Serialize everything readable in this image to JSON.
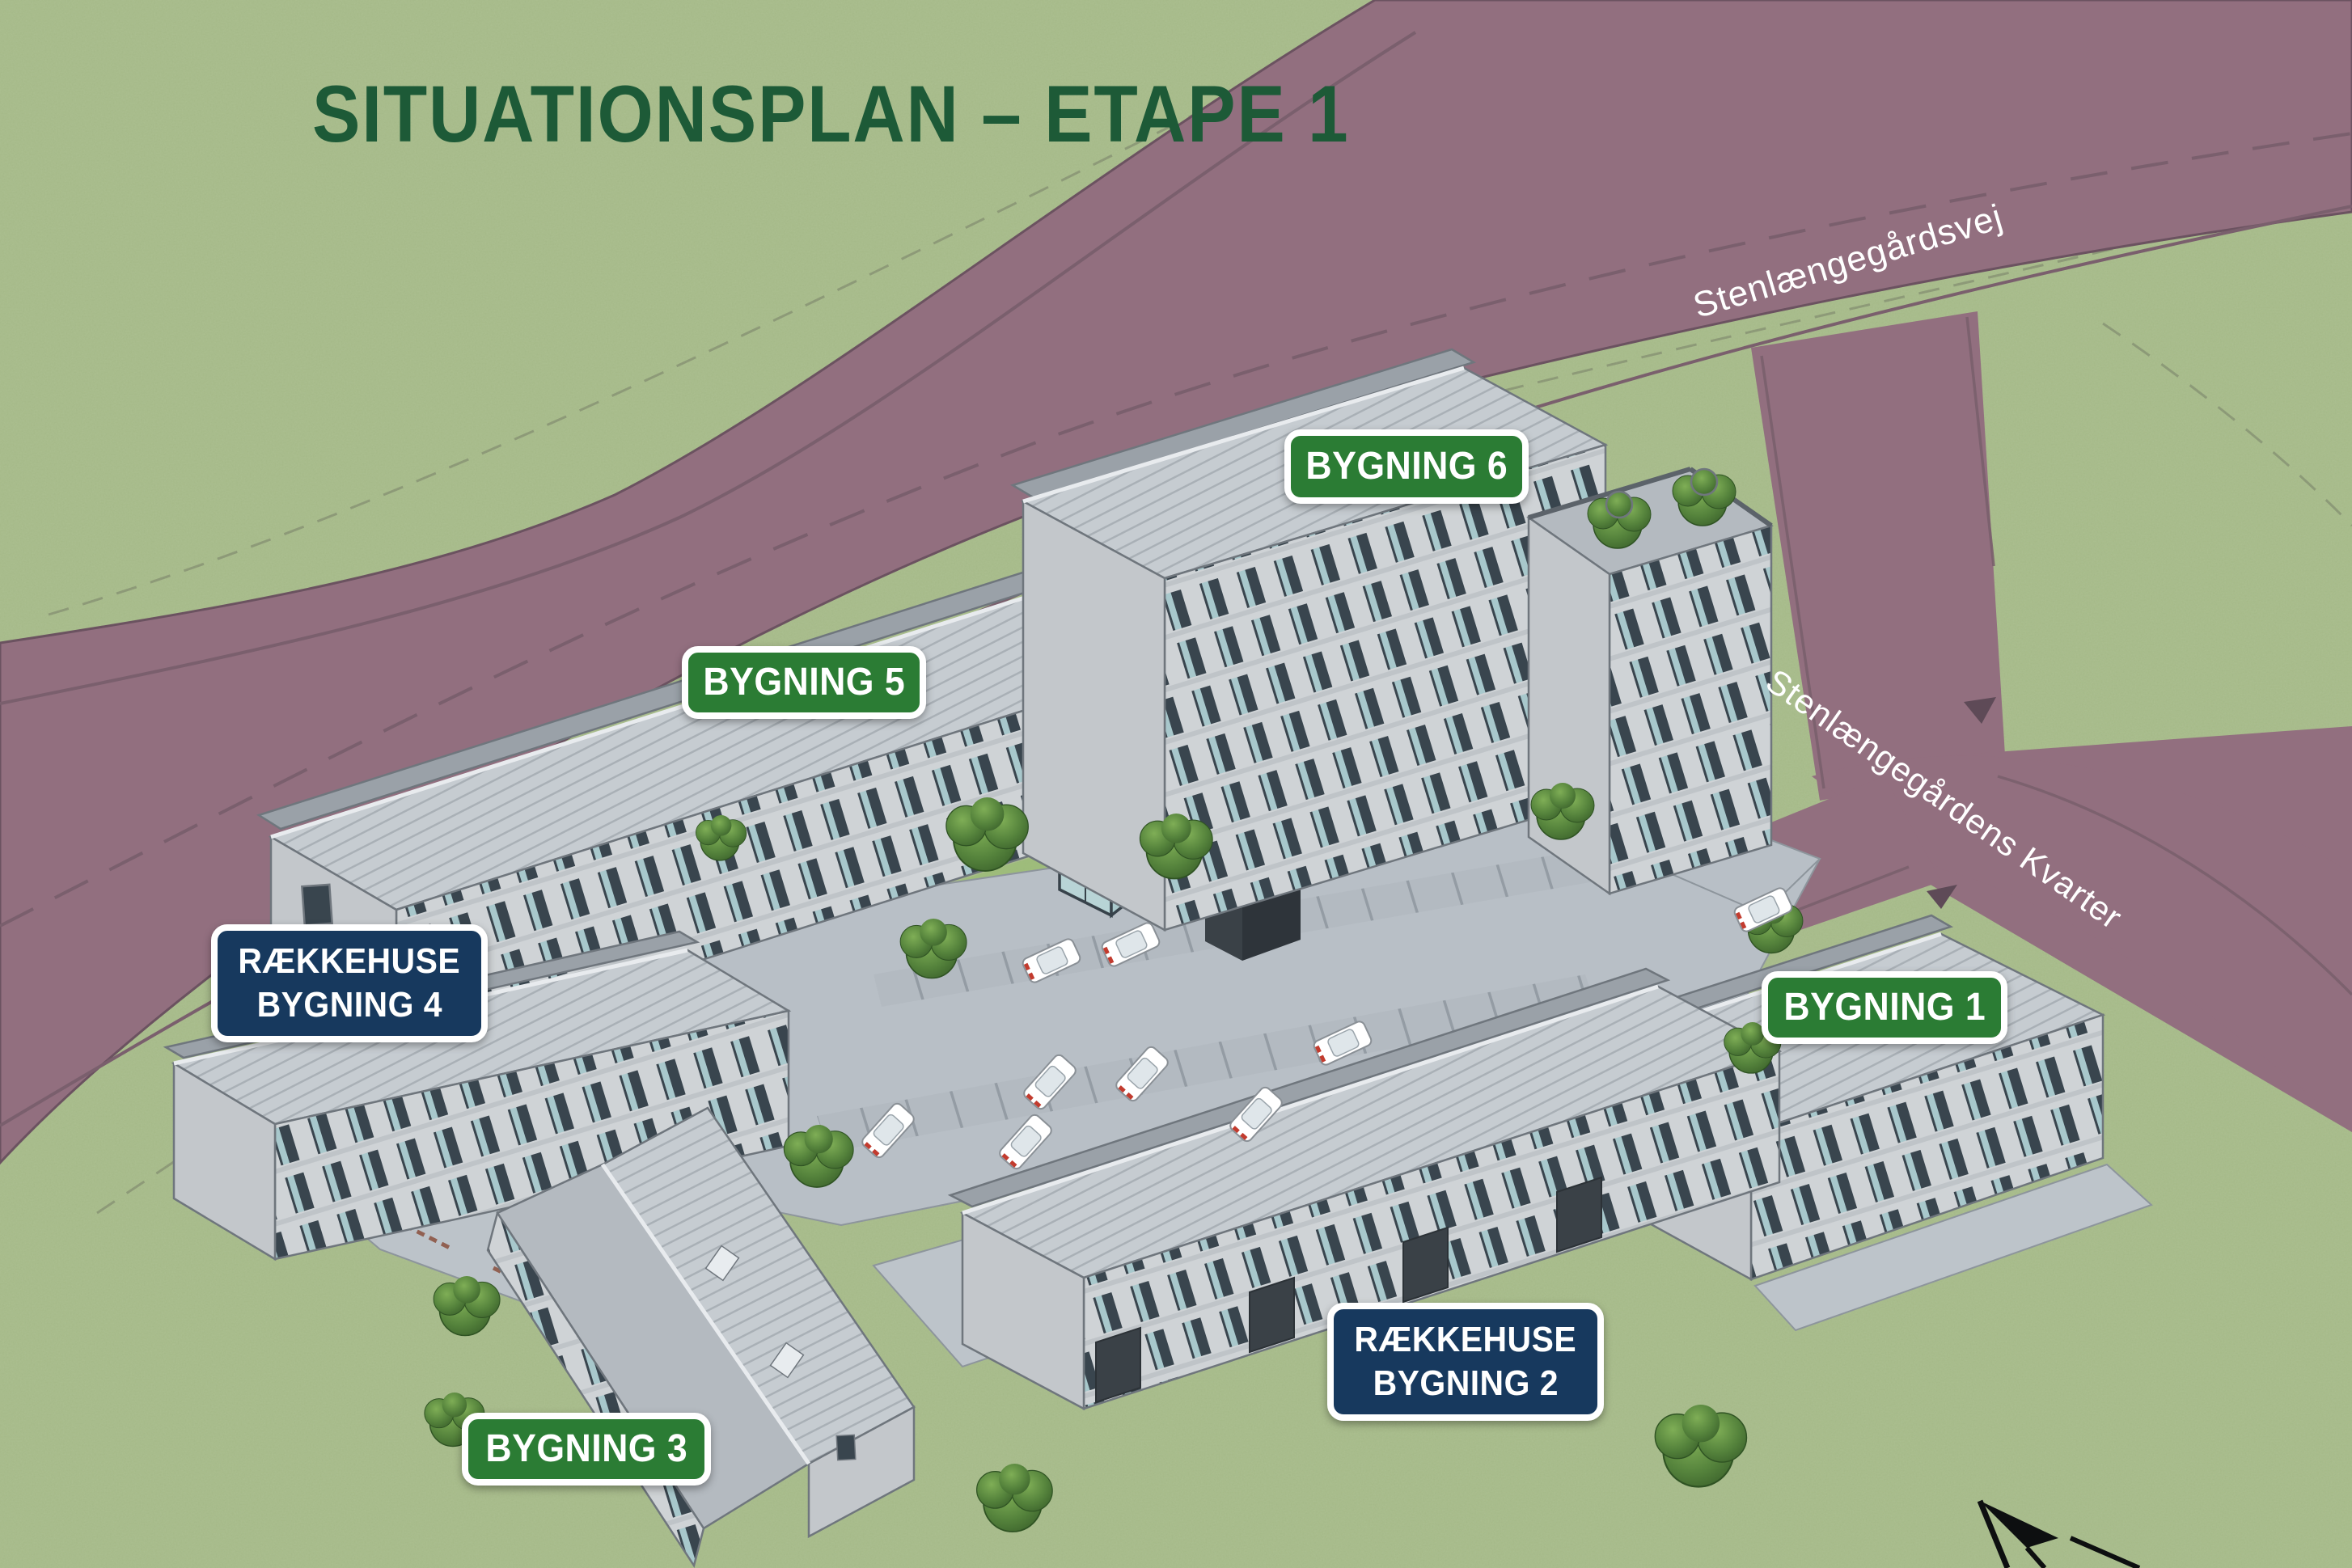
{
  "title": "SITUATIONSPLAN – ETAPE 1",
  "streets": [
    {
      "name": "Stenlængegårdsvej"
    },
    {
      "name": "Stenlængegårdens Kvarter"
    }
  ],
  "building_labels": [
    {
      "style": "green",
      "lines": [
        "BYGNING 6"
      ]
    },
    {
      "style": "green",
      "lines": [
        "BYGNING 5"
      ]
    },
    {
      "style": "navy",
      "lines": [
        "RÆKKEHUSE",
        "BYGNING 4"
      ]
    },
    {
      "style": "green",
      "lines": [
        "BYGNING 1"
      ]
    },
    {
      "style": "navy",
      "lines": [
        "RÆKKEHUSE",
        "BYGNING 2"
      ]
    },
    {
      "style": "green",
      "lines": [
        "BYGNING 3"
      ]
    }
  ],
  "map_features": {
    "north_arrow_icon": "north-arrow",
    "greenhouse_count": 2,
    "parked_car_count": 9
  },
  "colors": {
    "title_text": "#1d5a37",
    "badge_green": "#2b7c34",
    "badge_navy": "#17395e",
    "road": "#926f7f",
    "grass": "#a5b988",
    "pavement": "#b9c0c7",
    "roof": "#c6ccd1",
    "facade": "#cfd3d6",
    "tree": "#4e7d39",
    "street_label_text": "#ffffff"
  }
}
